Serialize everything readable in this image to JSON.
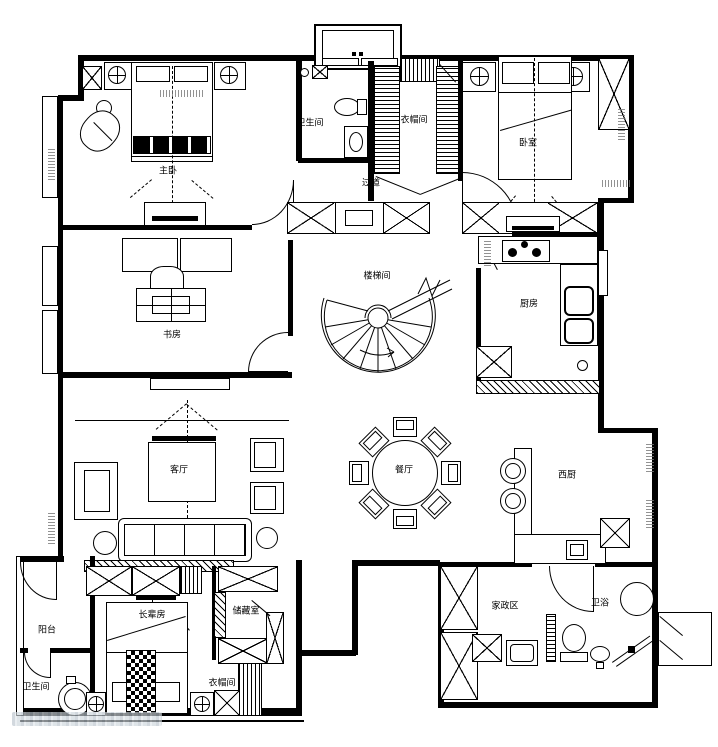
{
  "document": {
    "type": "residential floor plan (CAD line drawing)",
    "colors": {
      "line": "#000000",
      "background": "#ffffff",
      "watermark": "#b9c3cc"
    }
  },
  "rooms": {
    "master_bedroom": "主卧",
    "bath_top": "卫生间",
    "cloak_top": "衣帽间",
    "corridor": "过道",
    "bedroom2": "卧室",
    "study": "书房",
    "stairwell": "楼梯间",
    "kitchen": "厨房",
    "dining": "餐厅",
    "living": "客厅",
    "balcony": "阳台",
    "bath_bottom_left": "卫生间",
    "elder_room": "长辈房",
    "storage": "储藏室",
    "closet_bottom": "衣帽间",
    "west_kitchen": "西厨",
    "housekeeping": "家政区",
    "bath_bottom_right": "卫浴"
  }
}
